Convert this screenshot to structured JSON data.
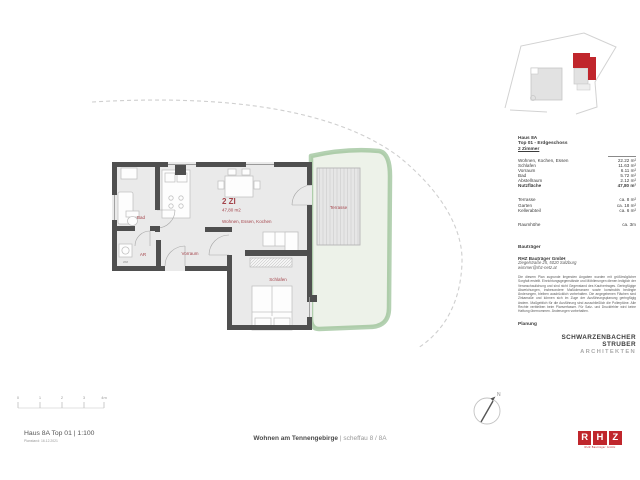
{
  "floor_plan": {
    "labels": {
      "unit": "2 ZI",
      "area": "47,80 m2",
      "living": "Wohnen, Essen, Kochen",
      "bad": "Bad",
      "ar": "AR",
      "wm": "WM",
      "vorraum": "Vorraum",
      "schlafen": "Schlafen",
      "terrasse": "Terrasse"
    },
    "label_color": "#a4444b",
    "wall_color": "#4f4f4f",
    "floor_color": "#eaeaea",
    "garden_fill": "#edf2e9",
    "garden_border": "#8cb888"
  },
  "scale_bar": {
    "ticks": [
      "0",
      "1",
      "2",
      "3",
      "4m"
    ]
  },
  "north_label": "N",
  "info_panel": {
    "house": "Haus 8A",
    "floor": "Top 01 - Erdgeschoss",
    "unit_type": "2 Zimmer",
    "rooms": [
      {
        "label": "Wohnen, Kochen, Essen",
        "value": "22.22 m²"
      },
      {
        "label": "Schlafen",
        "value": "11.63 m²"
      },
      {
        "label": "Vorraum",
        "value": "6.11 m²"
      },
      {
        "label": "Bad",
        "value": "5.72 m²"
      },
      {
        "label": "Abstellraum",
        "value": "2.12 m²"
      }
    ],
    "total": {
      "label": "Nutzfläche",
      "value": "47,80 m²"
    },
    "outdoor": [
      {
        "label": "Terrasse",
        "value": "ca. 8 m²"
      },
      {
        "label": "Garten",
        "value": "ca. 18 m²"
      },
      {
        "label": "Kellerabteil",
        "value": "ca. 6 m²"
      }
    ],
    "height": {
      "label": "Raumhöhe",
      "value": "ca. 3m"
    },
    "developer": {
      "header": "Bauträger",
      "name": "RHZ Bauträger GmbH",
      "address": "Ziegelstraße 25, 5020 Salzburg",
      "email": "wimmer@rhz-netz.at",
      "disclaimer": "Die diesem Plan zugrunde liegenden Angaben wurden mit größtmöglicher Sorgfalt erstellt. Einrichtungsgegenstände und Möblierungen dienen lediglich der Veranschaulichung und sind nicht Gegenstand des Kaufvertrages. Geringfügige Abweichungen, insbesondere Maßtoleranzen sowie konstruktiv bedingte Änderungen, bleiben ausdrücklich vorbehalten. Die angegebenen Flächen sind Zirkamaße und können sich im Zuge der Ausführungsplanung geringfügig ändern. Maßgeblich für die Ausführung sind ausschließlich die Polierpläne. Alle Rechte verbleiben beim Planverfasser. Für Satz- und Druckfehler wird keine Haftung übernommen. Änderungen vorbehalten."
    },
    "planning": {
      "header": "Planung",
      "firm_line1": "SCHWARZENBACHER",
      "firm_line2": "STRUBER",
      "firm_line3": "ARCHITEKTEN"
    }
  },
  "logo": {
    "letters": [
      "R",
      "H",
      "Z"
    ],
    "tagline": "RHZ Bauträger GmbH",
    "color": "#c0262c"
  },
  "footer": {
    "left_title": "Haus 8A Top 01 | 1:100",
    "left_sub": "Planstand: 16.12.2021",
    "center_bold": "Wohnen am Tennengebirge",
    "center_rest": " | scheffau 8 / 8A"
  }
}
